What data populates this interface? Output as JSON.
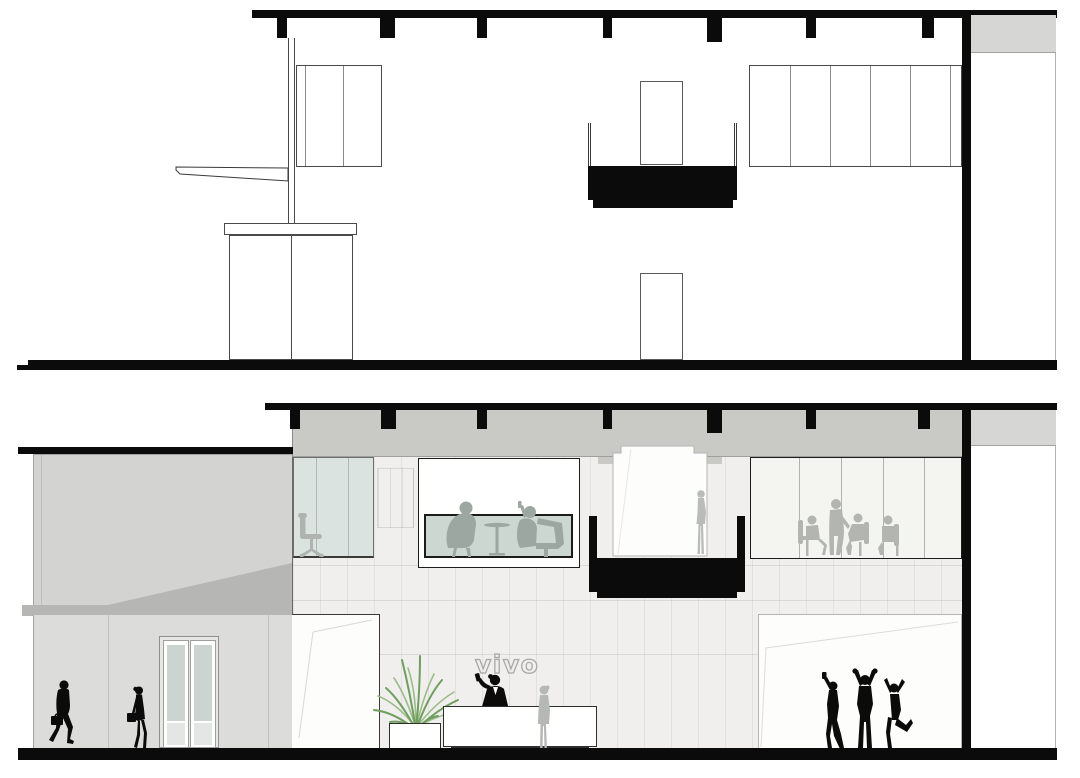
{
  "branding": {
    "logo_text": "vivo"
  },
  "drawing": {
    "title": "vivo retail store — building sections",
    "views": [
      {
        "id": "upper-section",
        "style": "black-and-white line drawing",
        "elements": [
          "roof slab with hanging joists",
          "wall cabinet",
          "cantilevered counter on column",
          "base cabinet",
          "suspended black soffit",
          "two doorway openings",
          "long wall cabinet run",
          "right service bay",
          "ground line"
        ]
      },
      {
        "id": "lower-section",
        "style": "rendered section elevation",
        "elements": [
          "street canopy and double entrance door",
          "walking pedestrians",
          "glazed office with task chair",
          "lounge meeting window",
          "stepped stage alcove with visitor",
          "suspended black soffit",
          "conference room window with meeting group",
          "tiled feature wall with vivo logo",
          "reception desk with receptionist and customer",
          "planter with plant",
          "white display wall with celebrating customers",
          "right service bay"
        ]
      }
    ],
    "figure_counts": {
      "pedestrians": 2,
      "office_chair": 1,
      "lounge_pair": 2,
      "stage_visitor": 1,
      "conference_group": 4,
      "receptionist": 1,
      "customer_at_desk": 1,
      "celebrating_group": 3
    }
  },
  "colors": {
    "ink": "#0b0b0b",
    "ceiling_gray": "#c9c9c6",
    "facade_gray_upper": "#d3d3d1",
    "facade_gray_lower": "#dcdcda",
    "canopy_gray": "#b6b6b4",
    "tile_wall": "#f0efed",
    "glass_teal": "#dbe3e0",
    "lounge_glass": "#cdd7d2",
    "silhouette_gray": "#a9aeab",
    "plant_green_dark": "#6f9e5f",
    "plant_green_light": "#9bbd8a",
    "logo_outline": "#a6a9a5",
    "bay_gray": "#d6d6d4"
  }
}
